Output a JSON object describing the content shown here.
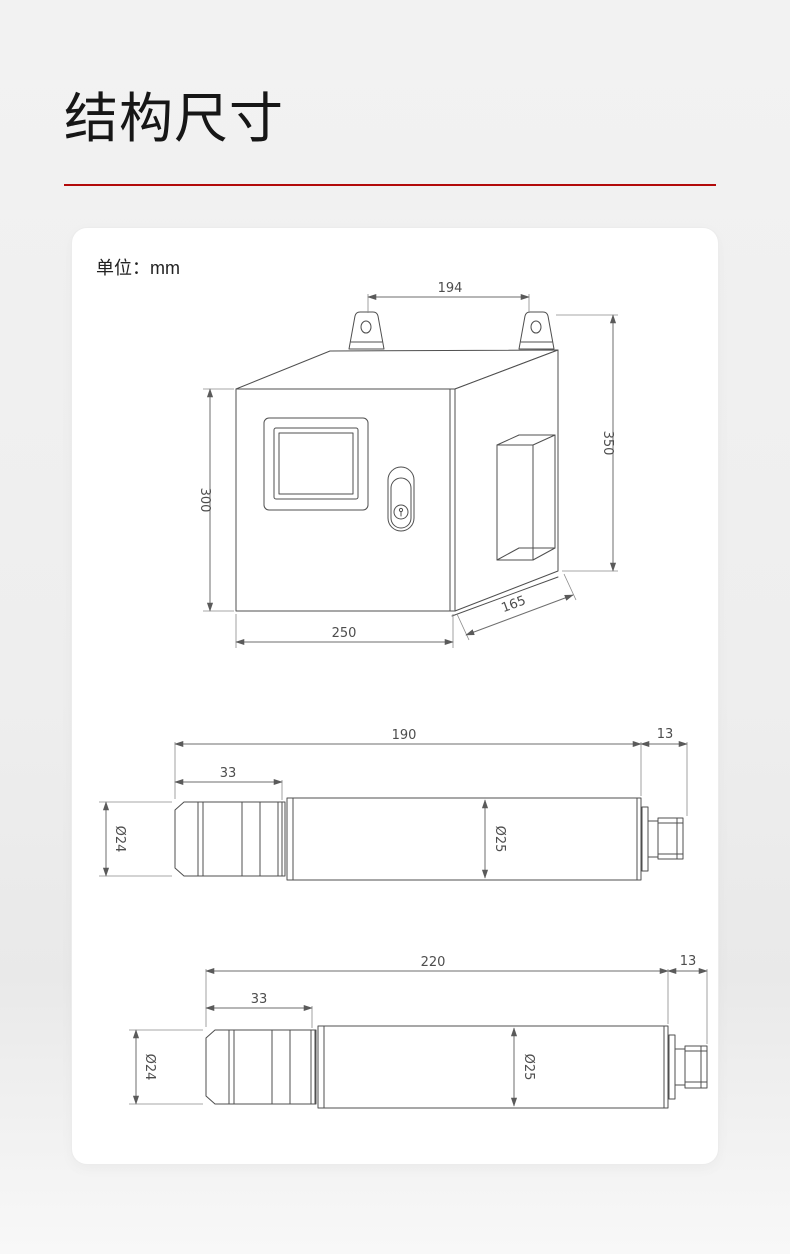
{
  "page": {
    "title": "结构尺寸",
    "unit_label": "单位：mm",
    "accent_color": "#b20a0a",
    "card_color": "#ffffff",
    "drawing_line_color": "#4f4f4f"
  },
  "drawings": {
    "cabinet": {
      "width_top": "194",
      "height_right": "350",
      "height_left": "300",
      "width_bottom": "250",
      "depth": "165"
    },
    "probe_a": {
      "length": "190",
      "connector_length": "13",
      "head_length": "33",
      "head_diameter": "Ø24",
      "body_diameter": "Ø25"
    },
    "probe_b": {
      "length": "220",
      "connector_length": "13",
      "head_length": "33",
      "head_diameter": "Ø24",
      "body_diameter": "Ø25"
    }
  }
}
